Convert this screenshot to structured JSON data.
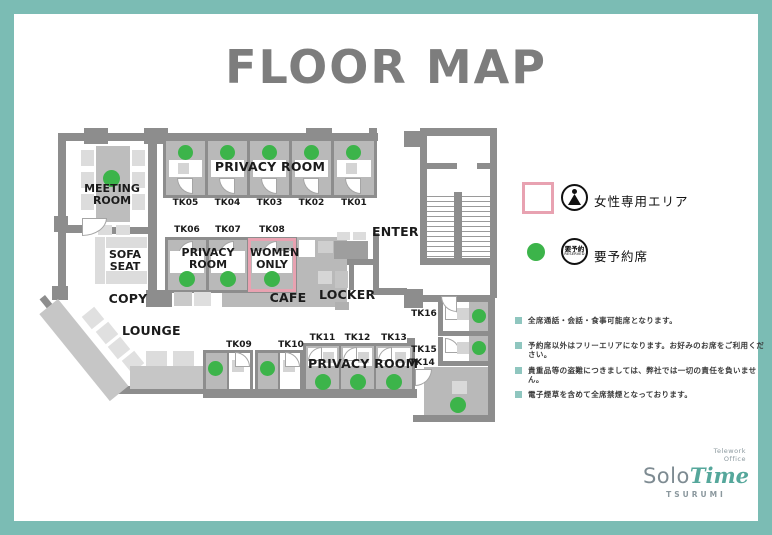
{
  "title": "FLOOR MAP",
  "legend": {
    "women_only_label": "女性専用エリア",
    "reserved_label": "要予約席",
    "reserved_icon_jp": "要予約",
    "reserved_icon_en": "RESERVED"
  },
  "notes": [
    "全席通話・会話・食事可能席となります。",
    "予約席以外はフリーエリアになります。お好みのお席をご利用ください。",
    "貴重品等の盗難につきましては、弊社では一切の責任を負いません。",
    "電子煙草を含めて全席禁煙となっております。"
  ],
  "map": {
    "meeting_room": "MEETING ROOM",
    "privacy_room_top": "PRIVACY ROOM",
    "privacy_room_mid": "PRIVACY ROOM",
    "privacy_room_bottom": "PRIVACY ROOM",
    "women_only": "WOMEN ONLY",
    "sofa_seat": "SOFA SEAT",
    "copy": "COPY",
    "cafe": "CAFE",
    "locker": "LOCKER",
    "lounge": "LOUNGE",
    "enter": "ENTER",
    "seats_top": [
      "TK05",
      "TK04",
      "TK03",
      "TK02",
      "TK01"
    ],
    "seats_mid": [
      "TK06",
      "TK07",
      "TK08"
    ],
    "seats_bottom_a": [
      "TK09",
      "TK10"
    ],
    "seats_bottom_b": [
      "TK11",
      "TK12",
      "TK13"
    ],
    "seats_right": [
      "TK16",
      "TK15",
      "TK14"
    ]
  },
  "brand": {
    "tagline_line1": "Telework",
    "tagline_line2": "Office",
    "name_solo": "Solo",
    "name_time": "Time",
    "location": "TSURUMI"
  },
  "colors": {
    "frame_teal": "#7bbcb4",
    "wall_gray": "#8d8d8d",
    "booth_gray": "#b9b9b9",
    "reserved_green": "#3cb44a",
    "women_pink": "#e8a2b1",
    "title_gray": "#7d7d7d",
    "note_bullet_teal": "#8fc6bf",
    "logo_teal": "#55a79b"
  }
}
